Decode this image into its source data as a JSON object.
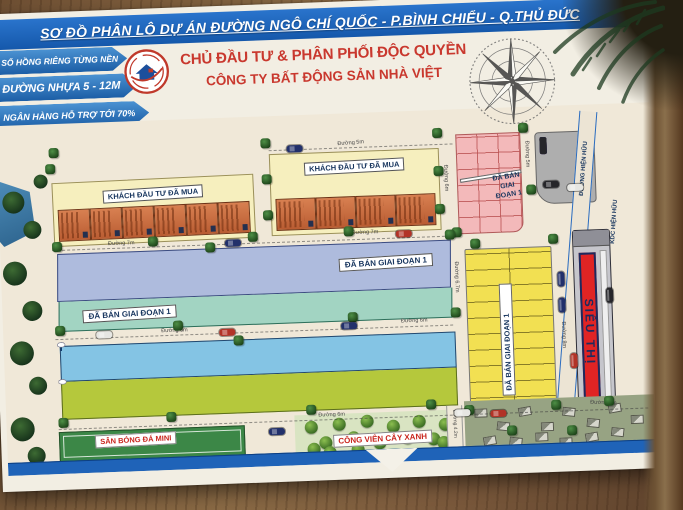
{
  "banner": {
    "title": "SƠ ĐỒ PHÂN LÔ DỰ ÁN ĐƯỜNG NGÔ CHÍ QUỐC - P.BÌNH CHIỂU - Q.THỦ ĐỨC"
  },
  "header": {
    "ribbons": [
      {
        "label": "SỔ HỒNG RIÊNG TỪNG NỀN"
      },
      {
        "label": "ĐƯỜNG NHỰA 5 - 12M"
      },
      {
        "label": "NGÂN HÀNG HỖ TRỢ TỚI 70%"
      },
      {
        "label": "XÂY DỰNG TỰ DO"
      }
    ],
    "developer_title": "CHỦ ĐẦU TƯ & PHÂN PHỐI ĐỘC QUYỀN",
    "company_name": "CÔNG TY BẤT ĐỘNG SẢN NHÀ VIỆT",
    "logo": "nha-viet-house-logo",
    "compass": "compass-rose"
  },
  "map": {
    "blocks": {
      "investor_block_west": {
        "label": "KHÁCH ĐẦU TƯ ĐÃ MUA",
        "houses": 6
      },
      "investor_block_east": {
        "label": "KHÁCH ĐẦU TƯ ĐÃ MUA",
        "houses": 4
      },
      "pink_block_north": {
        "label": "ĐÃ BÁN GIAI ĐOẠN 1"
      },
      "strip_blue": {
        "label": "ĐÃ BÁN GIAI ĐOẠN 1",
        "lots": 27
      },
      "strip_teal": {
        "label": "ĐÃ BÁN GIAI ĐOẠN 1",
        "lots": 27
      },
      "block_yellow_east": {
        "label": "ĐÃ BÁN GIAI ĐOẠN 1"
      },
      "row_cyan": {
        "lots": 29
      },
      "row_green": {
        "lots": 29
      },
      "supermarket": {
        "label": "SIÊU THỊ"
      },
      "parking": {
        "label": "BÃI ĐỖ XE"
      },
      "soccer_field": {
        "label": "SÂN BÓNG ĐÁ MINI"
      },
      "green_park": {
        "label": "CÔNG VIÊN CÂY XANH"
      }
    },
    "roads": {
      "north": "Đường 5m",
      "mid_upper_west": "Đường 7m",
      "mid_upper_east": "Đường 7m",
      "v_between_blocks": "Đường 6m",
      "v_pink_east": "Đường 5m",
      "mid_lower_west": "Đường 6m",
      "mid_lower_east": "Đường 6m",
      "v_6_7": "Đường 6.7m",
      "v_market": "Đường 8m",
      "south": "Đường 6m",
      "south_east": "Đường 8m",
      "park_side": "Đường 4.2m",
      "existing_road": "ĐƯỜNG HIỆN HỮU"
    },
    "areas": {
      "existing_residential": "KDC HIỆN HỮU"
    }
  },
  "colors": {
    "banner_blue": "#1a63bf",
    "ribbon_blue": "#2f7ac0",
    "heading_red": "#c9382e",
    "label_navy": "#17355e",
    "yellow_block": "#f6efbe",
    "pink_block": "#f3b9ba",
    "strip_blue": "#aebbdd",
    "strip_teal": "#a2d4c2",
    "row_cyan": "#84c4e4",
    "row_green": "#b5c83c",
    "block_yellow": "#f2e052",
    "market_red": "#e02424",
    "map_cream": "#f0e8d8",
    "tree_green": "#2f6b33",
    "wood_brown": "#7a5a3a"
  }
}
